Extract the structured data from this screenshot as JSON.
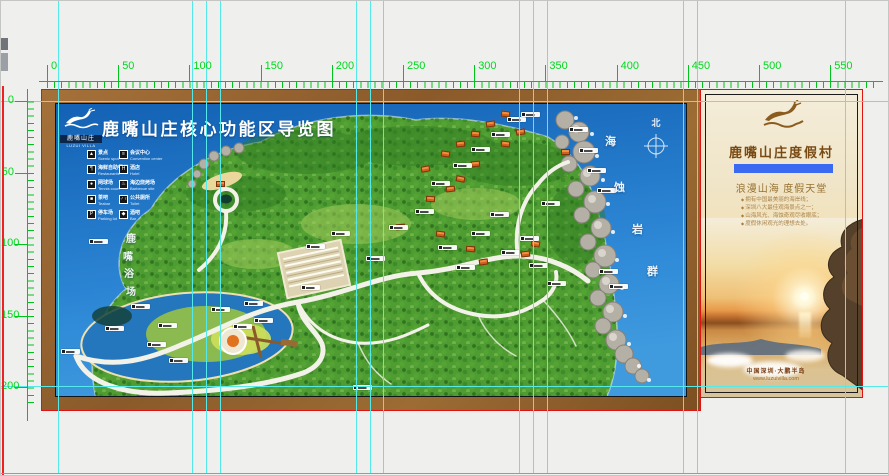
{
  "canvas": {
    "bg": "#eff0ee",
    "guide_color": "#55e9e9",
    "red_edge_color": "#ee2222",
    "ruler_color": "#00c41c",
    "ruler_text_color": "#00d81e"
  },
  "rulers": {
    "top": {
      "unit_labels": [
        "0",
        "50",
        "100",
        "150",
        "200",
        "250",
        "300",
        "350",
        "400",
        "450",
        "500",
        "550"
      ],
      "step_px": 71.2,
      "origin_px": 46
    },
    "left": {
      "unit_labels": [
        "0",
        "50",
        "100",
        "150",
        "200"
      ],
      "step_px": 71.6,
      "origin_px": 100
    }
  },
  "guides": {
    "vertical_x": [
      57,
      191,
      205,
      219,
      355,
      369,
      382,
      518,
      532,
      546,
      682,
      696,
      844
    ],
    "horizontal_y": [
      100,
      385
    ]
  },
  "map_sign": {
    "logo": {
      "cn": "鹿嘴山庄",
      "en": "LUZUI VILLA"
    },
    "title": "鹿嘴山庄核心功能区导览图",
    "legend": {
      "col1": [
        {
          "icon": "▲",
          "cn": "景点",
          "en": "Scenic spot"
        },
        {
          "icon": "¶",
          "cn": "海鲜自助餐厅",
          "en": "Restaurants"
        },
        {
          "icon": "●",
          "cn": "网球场",
          "en": "Tennis court"
        },
        {
          "icon": "■",
          "cn": "茶吧",
          "en": "Teabar"
        },
        {
          "icon": "P",
          "cn": "停车场",
          "en": "Parking lot"
        }
      ],
      "col2": [
        {
          "icon": "≡",
          "cn": "会议中心",
          "en": "Convention center"
        },
        {
          "icon": "H",
          "cn": "酒店",
          "en": "Hotel"
        },
        {
          "icon": "♨",
          "cn": "海边烧烤场",
          "en": "Barbecue site"
        },
        {
          "icon": "♂♀",
          "cn": "公共厕所",
          "en": "Toilet"
        },
        {
          "icon": "◆",
          "cn": "酒吧",
          "en": "Bar"
        }
      ]
    },
    "compass_label": "北",
    "beach_vertical_label": "鹿嘴浴场",
    "reef_vertical_label": "海蚀岩群",
    "markers": [
      [
        33,
        135
      ],
      [
        49,
        222
      ],
      [
        75,
        200
      ],
      [
        102,
        219
      ],
      [
        91,
        238
      ],
      [
        113,
        254
      ],
      [
        5,
        245
      ],
      [
        155,
        203
      ],
      [
        177,
        220
      ],
      [
        188,
        197
      ],
      [
        198,
        214
      ],
      [
        250,
        140
      ],
      [
        245,
        181
      ],
      [
        275,
        127
      ],
      [
        297,
        281
      ],
      [
        310,
        152
      ],
      [
        333,
        121
      ],
      [
        359,
        105
      ],
      [
        382,
        141
      ],
      [
        400,
        161
      ],
      [
        415,
        127
      ],
      [
        434,
        108
      ],
      [
        445,
        146
      ],
      [
        464,
        132
      ],
      [
        485,
        97
      ],
      [
        375,
        77
      ],
      [
        397,
        59
      ],
      [
        415,
        43
      ],
      [
        435,
        28
      ],
      [
        451,
        13
      ],
      [
        465,
        8
      ],
      [
        513,
        23
      ],
      [
        523,
        44
      ],
      [
        531,
        64
      ],
      [
        541,
        84
      ],
      [
        473,
        159
      ],
      [
        491,
        177
      ],
      [
        543,
        165
      ],
      [
        553,
        180
      ]
    ],
    "buildings": [
      [
        365,
        62,
        -10
      ],
      [
        385,
        47,
        8
      ],
      [
        400,
        37,
        -6
      ],
      [
        415,
        27,
        5
      ],
      [
        430,
        17,
        -8
      ],
      [
        445,
        7,
        6
      ],
      [
        400,
        72,
        12
      ],
      [
        415,
        57,
        -5
      ],
      [
        445,
        37,
        7
      ],
      [
        460,
        25,
        -9
      ],
      [
        370,
        92,
        4
      ],
      [
        390,
        82,
        -7
      ],
      [
        475,
        137,
        10
      ],
      [
        465,
        147,
        -6
      ],
      [
        410,
        142,
        5
      ],
      [
        423,
        155,
        -8
      ],
      [
        380,
        127,
        7
      ],
      [
        340,
        120,
        -5
      ],
      [
        160,
        77,
        0
      ],
      [
        505,
        45,
        0
      ]
    ]
  },
  "poster": {
    "title": "鹿嘴山庄度假村",
    "subtitle": "浪漫山海  度假天堂",
    "bullets": [
      "拥有中国最美丽的海岸线；",
      "深圳八大最佳观海景点之一；",
      "山海风光、海蚀奇观尽收眼底；",
      "度假休闲观光的理想去处。"
    ],
    "footer_line1": "中国深圳·大鹏半岛",
    "footer_line2": "www.luzuivilla.com",
    "accent_bar_color": "#3a6af2"
  }
}
